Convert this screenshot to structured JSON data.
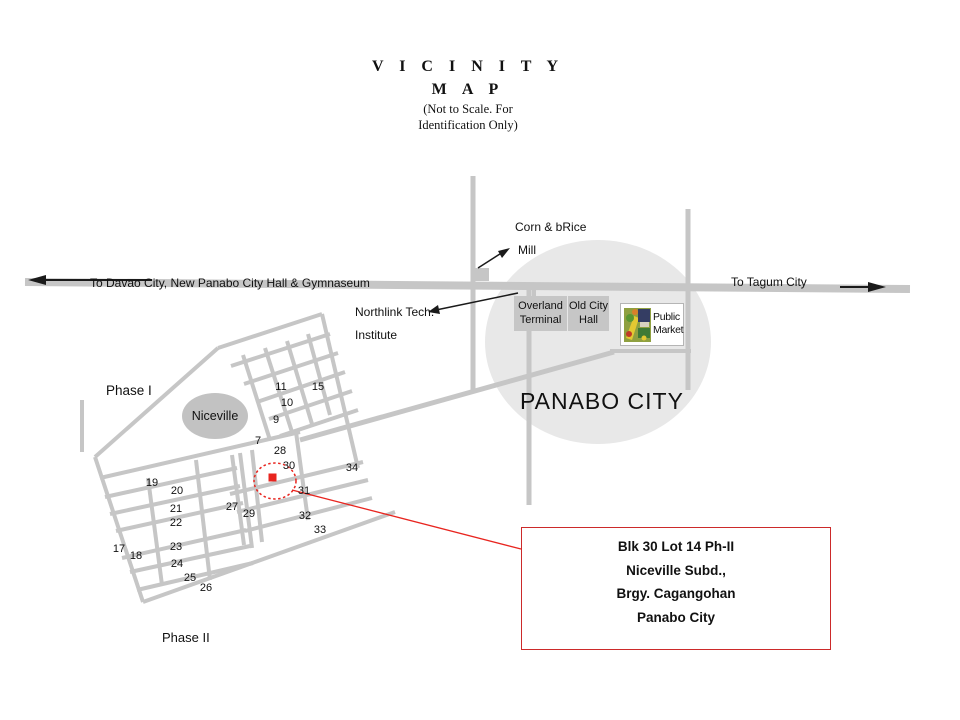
{
  "title": {
    "line1": "V I C I N I T Y",
    "line2": "M A P",
    "note_line1": "(Not to Scale. For",
    "note_line2": "Identification Only)"
  },
  "roads": {
    "left_label": "To Davao City, New Panabo City Hall & Gymnaseum",
    "right_label": "To Tagum City"
  },
  "landmarks": {
    "mill_line1": "Corn & bRice",
    "mill_line2": "Mill",
    "northlink_line1": "Northlink Tech.",
    "northlink_line2": "Institute",
    "overland_line1": "Overland",
    "overland_line2": "Terminal",
    "old_city_line1": "Old City",
    "old_city_line2": "Hall",
    "market_line1": "Public",
    "market_line2": "Market",
    "city_name": "PANABO CITY"
  },
  "subdivision": {
    "phase1_label": "Phase I",
    "phase2_label": "Phase II",
    "name": "Niceville",
    "block_numbers": [
      {
        "n": "7",
        "x": 258,
        "y": 441
      },
      {
        "n": "9",
        "x": 276,
        "y": 420
      },
      {
        "n": "10",
        "x": 287,
        "y": 403
      },
      {
        "n": "11",
        "x": 281,
        "y": 387
      },
      {
        "n": "15",
        "x": 318,
        "y": 387
      },
      {
        "n": "17",
        "x": 119,
        "y": 549
      },
      {
        "n": "18",
        "x": 136,
        "y": 556
      },
      {
        "n": "19",
        "x": 152,
        "y": 483
      },
      {
        "n": "20",
        "x": 177,
        "y": 491
      },
      {
        "n": "21",
        "x": 176,
        "y": 509
      },
      {
        "n": "22",
        "x": 176,
        "y": 523
      },
      {
        "n": "23",
        "x": 176,
        "y": 547
      },
      {
        "n": "24",
        "x": 177,
        "y": 564
      },
      {
        "n": "25",
        "x": 190,
        "y": 578
      },
      {
        "n": "26",
        "x": 206,
        "y": 588
      },
      {
        "n": "27",
        "x": 232,
        "y": 507
      },
      {
        "n": "28",
        "x": 280,
        "y": 451
      },
      {
        "n": "29",
        "x": 249,
        "y": 514
      },
      {
        "n": "30",
        "x": 289,
        "y": 466
      },
      {
        "n": "31",
        "x": 304,
        "y": 491
      },
      {
        "n": "32",
        "x": 305,
        "y": 516
      },
      {
        "n": "33",
        "x": 320,
        "y": 530
      },
      {
        "n": "34",
        "x": 352,
        "y": 468
      }
    ]
  },
  "callout": {
    "line1": "Blk 30 Lot 14 Ph-II",
    "line2": "Niceville Subd.,",
    "line3": "Brgy. Cagangohan",
    "line4": "Panabo City"
  },
  "colors": {
    "road_gray": "#c6c6c6",
    "city_circle_fill": "#e8e8e8",
    "landmark_box_fill": "#c6c6c6",
    "accent_red": "#e8251f",
    "callout_border_red": "#cc2a2a"
  }
}
